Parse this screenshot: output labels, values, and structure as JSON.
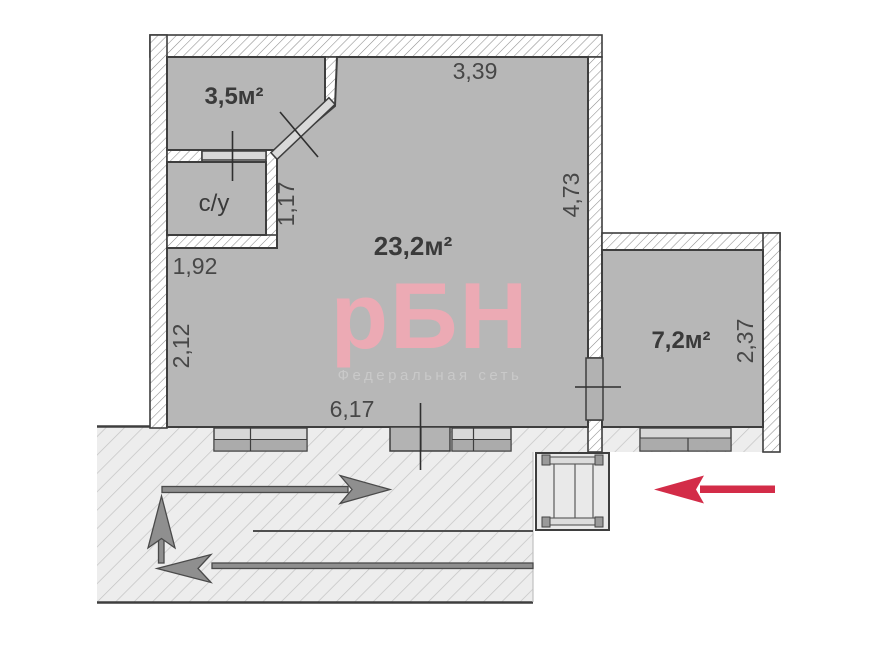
{
  "watermark": {
    "logo": "рБН",
    "tagline": "Федеральная сеть"
  },
  "rooms": {
    "hallway": {
      "area": "3,5м²"
    },
    "bathroom": {
      "name": "с/у"
    },
    "main": {
      "area": "23,2м²"
    },
    "bedroom": {
      "area": "7,2м²"
    }
  },
  "dimensions": {
    "main_top": "3,39",
    "main_right": "4,73",
    "bathroom_side": "1,17",
    "bathroom_bottom": "1,92",
    "main_left": "2,12",
    "main_bottom": "6,17",
    "bedroom_right": "2,37"
  },
  "colors": {
    "room_fill": "#b7b7b7",
    "wall_outline": "#3e3e3e",
    "entrance_arrow_red": "#d32c48",
    "stair_arrow_gray": "#8f8f8f",
    "watermark_pink": "#ecaab4",
    "watermark_tagline_gray": "#c9c9c9"
  }
}
